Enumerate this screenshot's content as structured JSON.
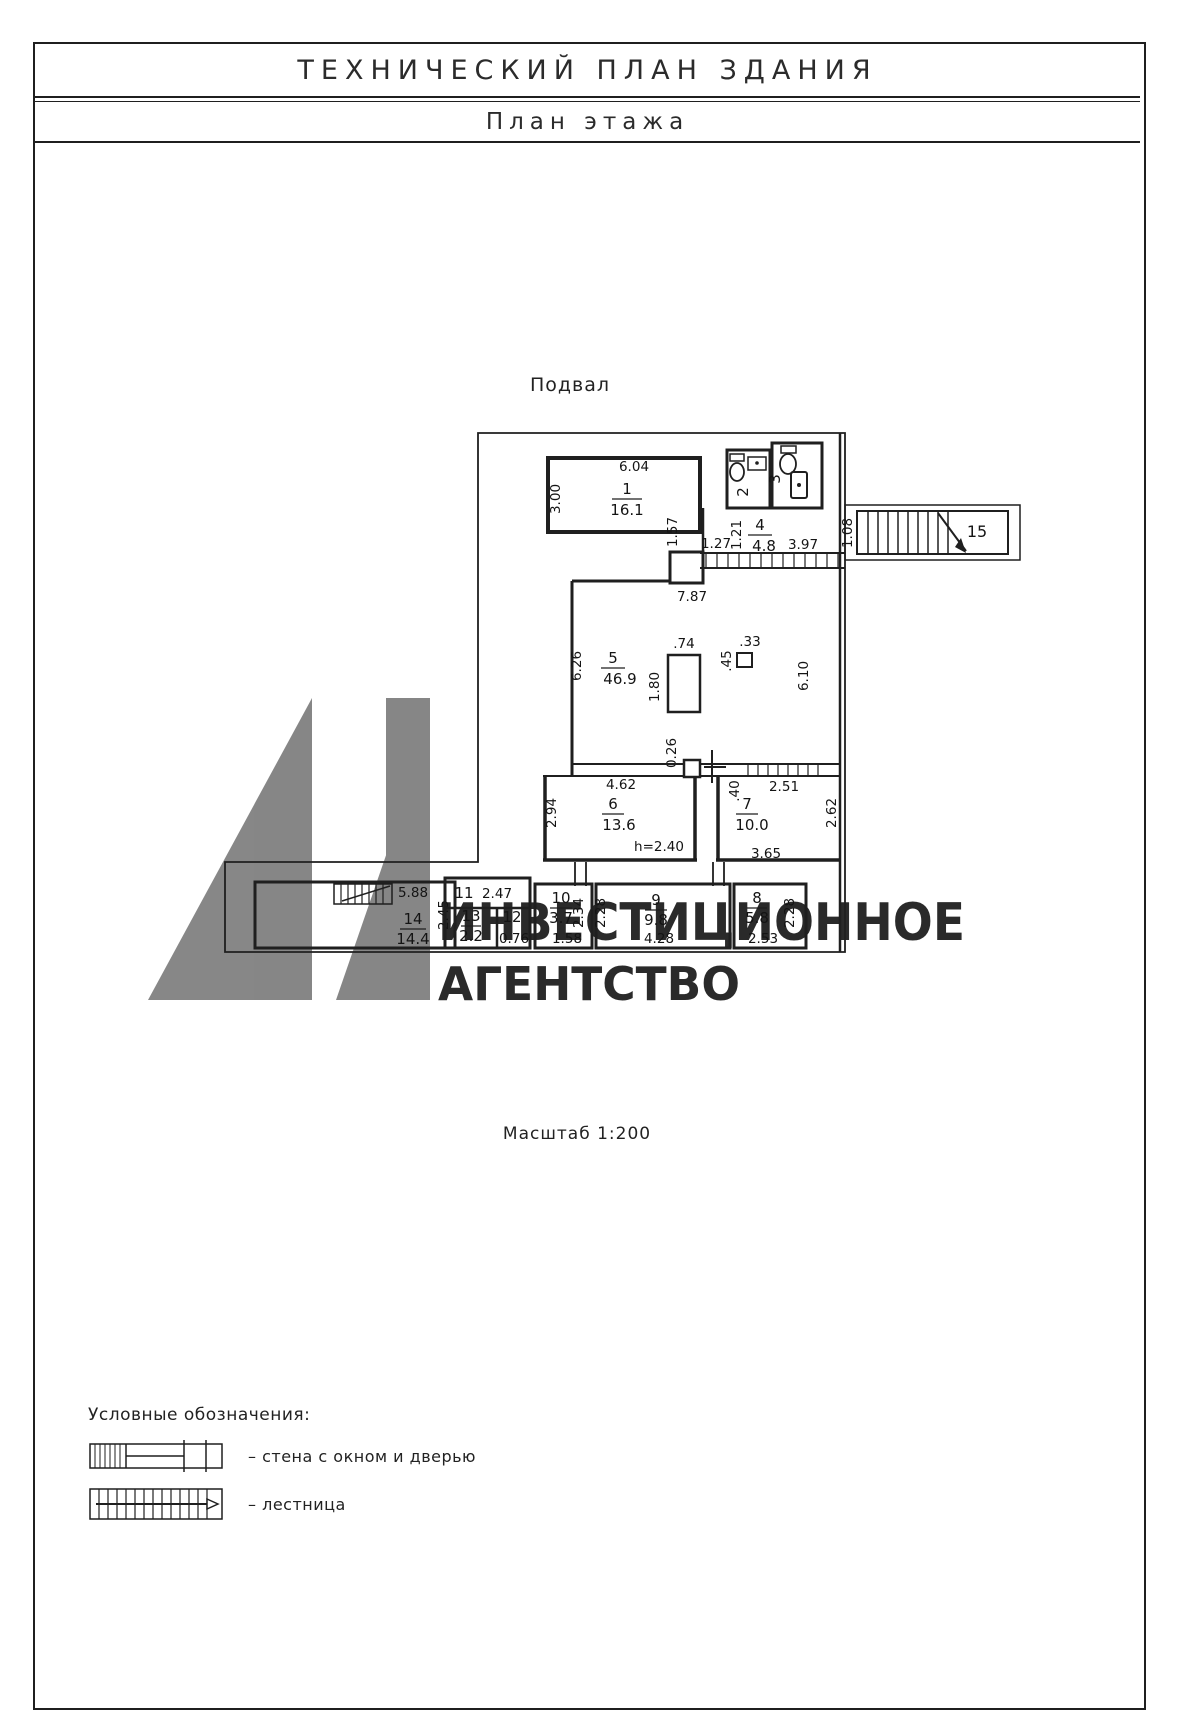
{
  "page": {
    "title": "ТЕХНИЧЕСКИЙ ПЛАН ЗДАНИЯ",
    "subtitle": "План этажа"
  },
  "plan": {
    "floor_label": "Подвал",
    "scale_label": "Масштаб 1:200",
    "rooms": {
      "r1": {
        "num": "1",
        "area": "16.1"
      },
      "r2": {
        "num": "2"
      },
      "r3": {
        "num": "3"
      },
      "r4": {
        "num": "4",
        "area": "4.8"
      },
      "r5": {
        "num": "5",
        "area": "46.9"
      },
      "r6": {
        "num": "6",
        "area": "13.6"
      },
      "r7": {
        "num": "7",
        "area": "10.0"
      },
      "r8": {
        "num": "8",
        "area": "5.8"
      },
      "r9": {
        "num": "9",
        "area": "9.8"
      },
      "r10": {
        "num": "10",
        "area": "3.7"
      },
      "r11": {
        "num": "11"
      },
      "r12": {
        "num": "12"
      },
      "r13": {
        "num": "13",
        "area": "2.2"
      },
      "r14": {
        "num": "14",
        "area": "14.4"
      },
      "r15": {
        "num": "15"
      }
    },
    "dims": {
      "room1_width": "6.04",
      "room1_depth": "3.00",
      "hall_gap": "1.27",
      "strip_157": "1.57",
      "hall_depth": "1.21",
      "hall_right": "3.97",
      "stairs_entry": "1.08",
      "hall_total": "7.87",
      "room5_left": "6.26",
      "column_width": ".74",
      "column_depth": "1.80",
      "pier_depth": ".45",
      "pier_width": ".33",
      "room5_right": "6.10",
      "wall_ledge": "0.26",
      "room6_width": "4.62",
      "room6_depth": "2.94",
      "ceiling_height": "h=2.40",
      "room7_door": ".40",
      "room7_window": "2.51",
      "room7_depth": "2.62",
      "room7_width": "3.65",
      "room14_width": "5.88",
      "room14_depth": "2.45",
      "room11_width": "2.47",
      "room12_width": "0.76",
      "room10_depth": "2.34",
      "room10_width": "1.58",
      "room9_left": "2.28",
      "room9_width": "4.28",
      "room8_depth": "2.28",
      "room8_width": "2.53"
    }
  },
  "watermark": {
    "line1": "ИНВЕСТИЦИОННОЕ",
    "line2": "АГЕНТСТВО",
    "color": "#7a7a7a"
  },
  "legend": {
    "heading": "Условные обозначения:",
    "items": [
      {
        "icon": "wall-window-door-symbol",
        "label": "– стена с окном и дверью"
      },
      {
        "icon": "staircase-symbol",
        "label": "– лестница"
      }
    ]
  }
}
